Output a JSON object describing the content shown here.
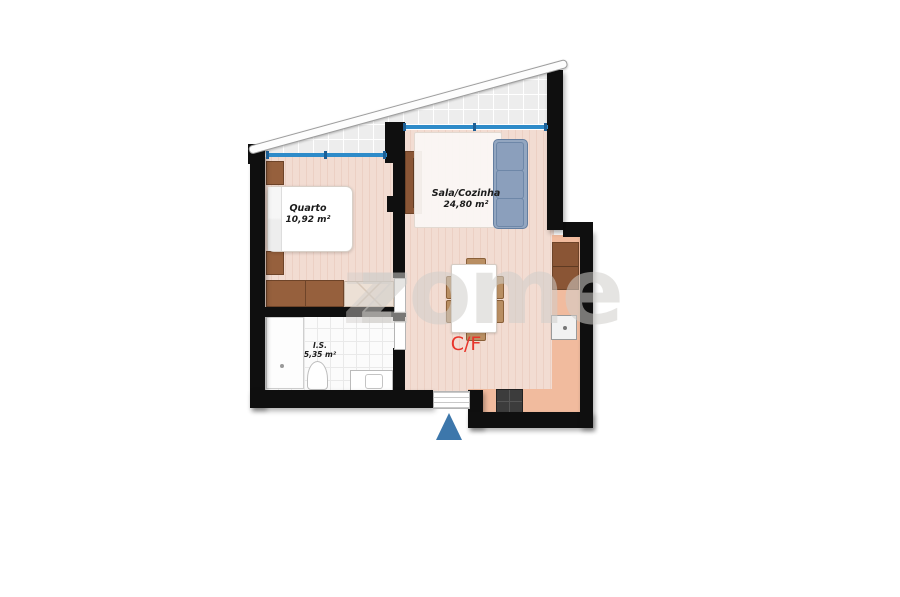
{
  "floorplan": {
    "rooms": [
      {
        "name": "Quarto",
        "area": "10,92 m²"
      },
      {
        "name": "Sala/Cozinha",
        "area": "24,80 m²"
      },
      {
        "name": "I.S.",
        "area": "5,35 m²"
      }
    ],
    "cf_label": "C/F",
    "watermark": "zome",
    "watermark_prefix": "z",
    "colors": {
      "wall": "#0f0f0f",
      "wood_floor": "#f2dcd2",
      "tile_floor": "#fbfbfb",
      "terrace": "#ededed",
      "kitchen_counter": "#f1bb9e",
      "window_blue": "#2e8bc9",
      "furniture_brown": "#96603d",
      "sofa_blue": "#93a6c0",
      "label_red": "#e8352b",
      "entrance_marker_blue": "#3d77ab"
    }
  }
}
